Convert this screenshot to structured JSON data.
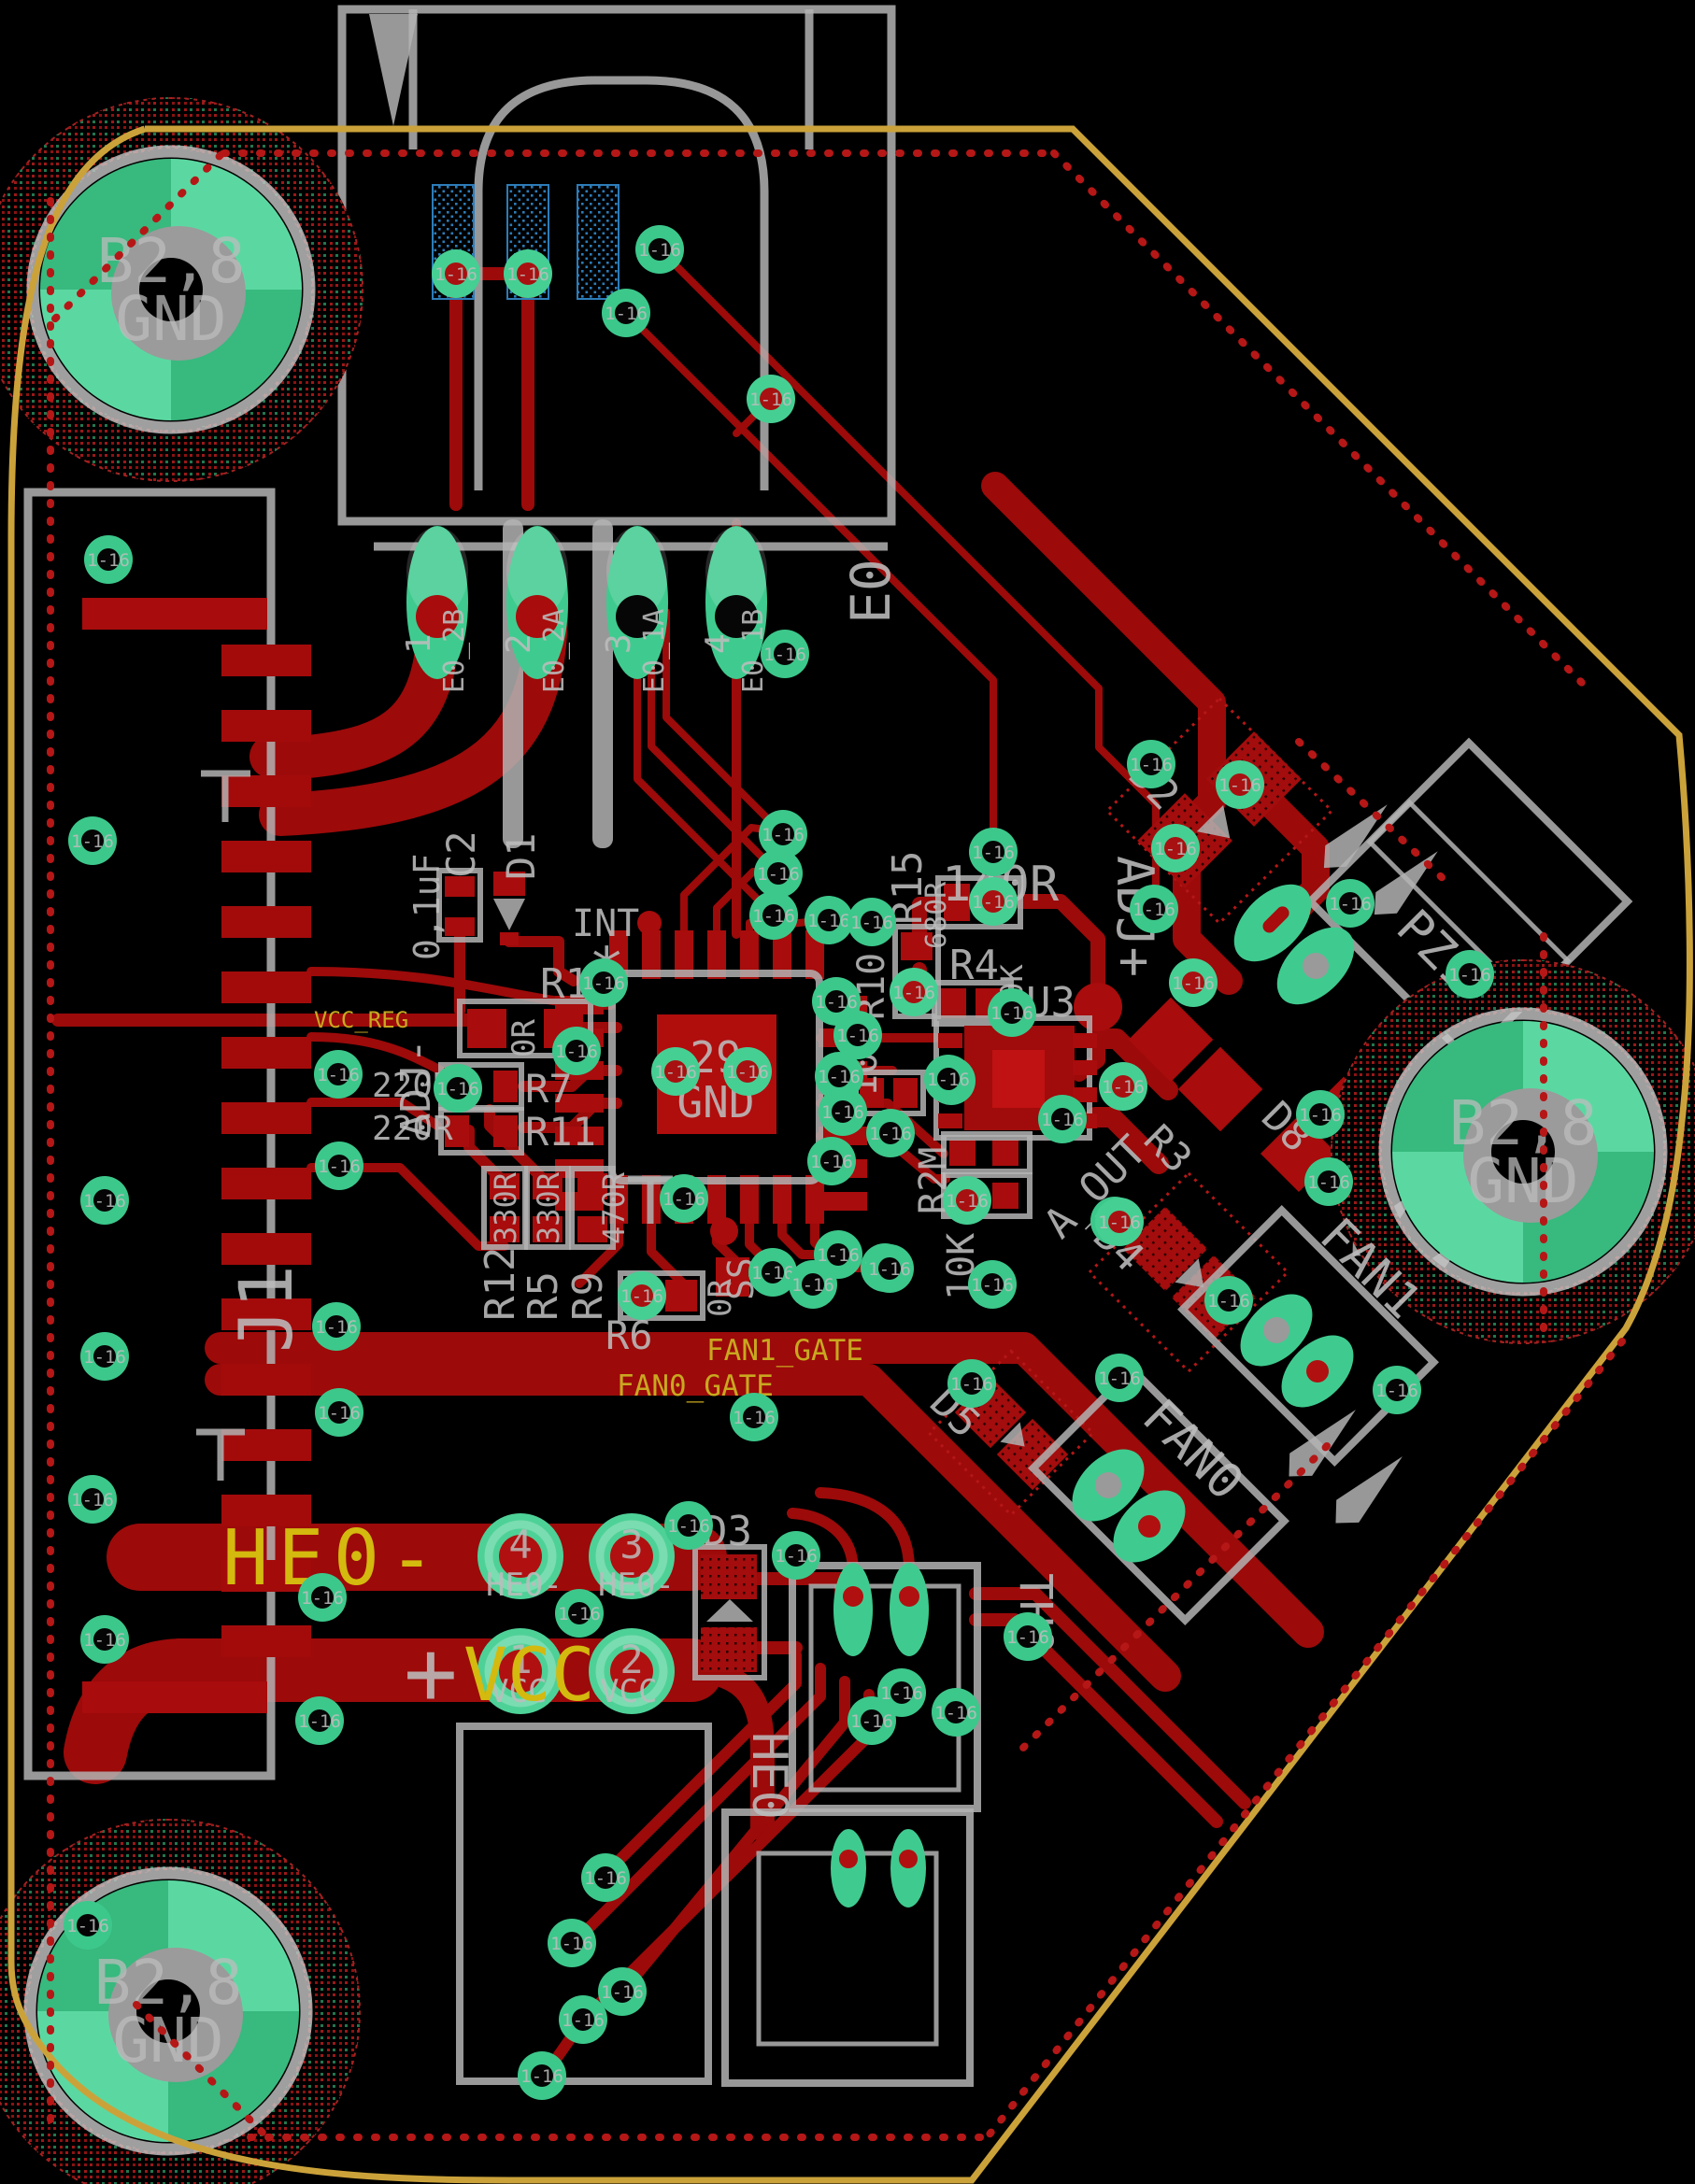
{
  "board": {
    "background": "#000000",
    "copper_color": "#9c0a0a",
    "pad_color": "#3fcb8f",
    "silk_color": "#b3b3b3",
    "edge_color": "#cba23a",
    "net_label_color": "#c9a81f"
  },
  "via_label": "1-16",
  "mount_hole": {
    "line1": "B2,8",
    "line2": "GND"
  },
  "ic": {
    "pad_num": "29",
    "pad_net": "GND"
  },
  "nets": {
    "vcc_reg": "VCC_REG",
    "fan1_gate": "FAN1_GATE",
    "fan0_gate": "FAN0_GATE",
    "he0_minus": "HE0-",
    "plus": "+",
    "vcc": "VCC",
    "adj_plus": "ADJ+",
    "adj_minus": "ADJ-",
    "a_out": "A_OUT",
    "int": "INT",
    "ss": "SS",
    "star": "*"
  },
  "connectors": {
    "e0": {
      "refdes": "E0",
      "pads": [
        {
          "num": "1",
          "net": "E0_2B"
        },
        {
          "num": "2",
          "net": "E0_2A"
        },
        {
          "num": "3",
          "net": "E0_1A"
        },
        {
          "num": "4",
          "net": "E0_1B"
        }
      ]
    },
    "j1": {
      "refdes": "J1"
    },
    "pz1": {
      "refdes": "PZ1"
    },
    "fan1": {
      "refdes": "FAN1"
    },
    "fan0": {
      "refdes": "FAN0"
    },
    "th0": {
      "refdes": "TH0"
    },
    "he0": {
      "refdes": "HE0"
    },
    "power_pads": [
      {
        "num": "4",
        "net": "HE0-"
      },
      {
        "num": "3",
        "net": "HE0-"
      },
      {
        "num": "1",
        "net": "VCC"
      },
      {
        "num": "2",
        "net": "VCC"
      }
    ]
  },
  "components": {
    "c2": {
      "refdes": "C2",
      "value": "0,1uF"
    },
    "d1": {
      "refdes": "D1"
    },
    "d2": {
      "refdes": "D2"
    },
    "d3": {
      "refdes": "D3"
    },
    "d4": {
      "refdes": "D4"
    },
    "d5": {
      "refdes": "D5"
    },
    "d8": {
      "refdes": "D8"
    },
    "r1": {
      "refdes": "R1",
      "value": "0R"
    },
    "r3": {
      "refdes": "R3"
    },
    "r4": {
      "refdes": "R4",
      "value": "10K"
    },
    "r5": {
      "refdes": "R5",
      "value": "330R"
    },
    "r6": {
      "refdes": "R6",
      "value": "0R"
    },
    "r7": {
      "refdes": "R7",
      "value": "220R"
    },
    "r9": {
      "refdes": "R9",
      "value": "470R"
    },
    "r10": {
      "refdes": "R10",
      "value": "10K"
    },
    "r11": {
      "refdes": "R11",
      "value": "220R"
    },
    "r12": {
      "refdes": "R12",
      "value": "330R"
    },
    "r15": {
      "refdes": "R15",
      "value": "680R"
    },
    "r2m": {
      "refdes": "R2M",
      "value": "10K"
    },
    "u3": {
      "refdes": "U3"
    },
    "value_140r": "140R"
  }
}
